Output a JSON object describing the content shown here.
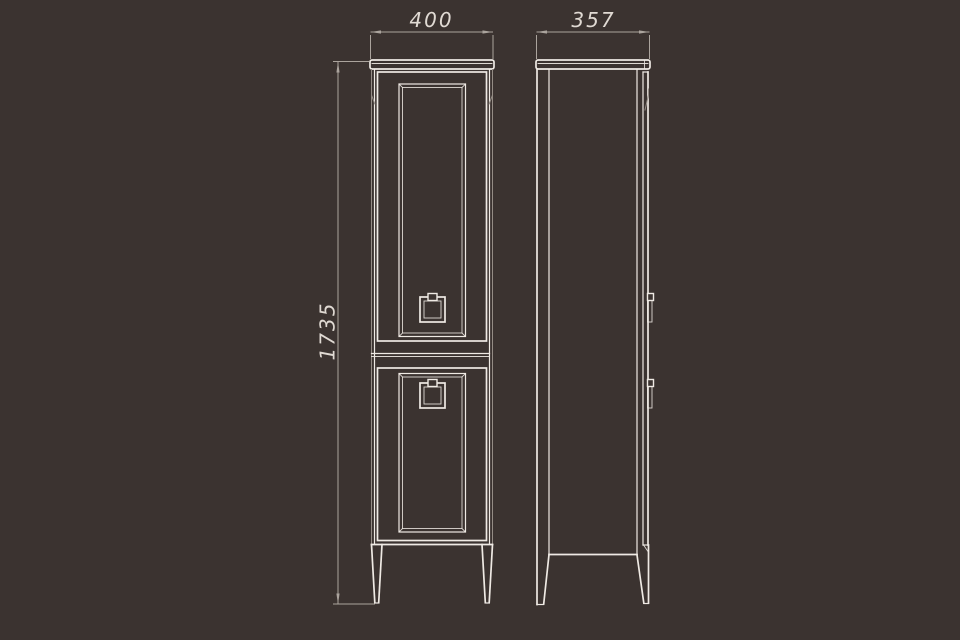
{
  "drawing": {
    "kind": "tall-cabinet-technical-drawing",
    "views": [
      "front-elevation",
      "side-elevation"
    ]
  },
  "dimensions": {
    "width": {
      "value": "400"
    },
    "depth": {
      "value": "357"
    },
    "height": {
      "value": "1735"
    }
  },
  "colors": {
    "background": "#3B3330",
    "outline": "#EFEAE4",
    "secondary_line": "#948C85",
    "dimension": "#ABA49D",
    "text": "#E0DAD3"
  }
}
